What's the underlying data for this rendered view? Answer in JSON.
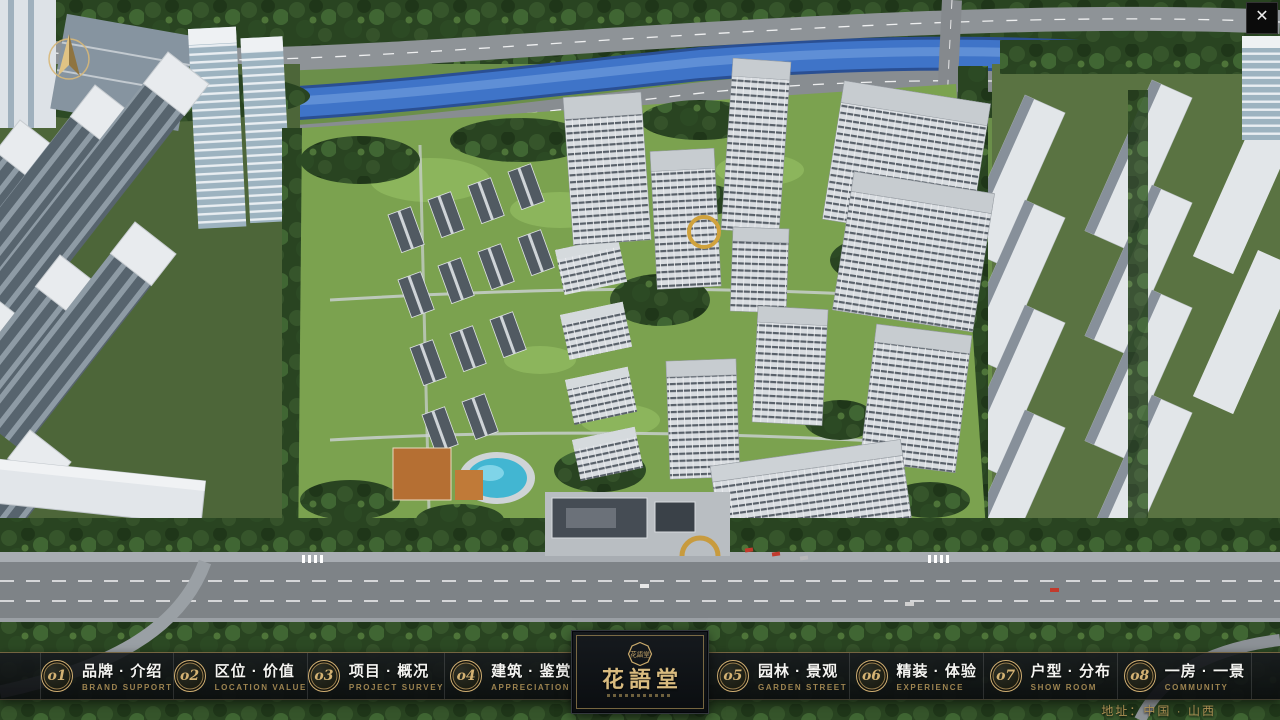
{
  "theme": {
    "accent_gold": "#c9a96b",
    "nav_background": "rgba(16,18,20,0.92)",
    "label_white": "#f4f4f1",
    "subtitle_gold": "#9d8450",
    "address_gold": "#ad9154",
    "river_blue": "#3f74c8",
    "foliage_green": "#2c4a24"
  },
  "icons": {
    "close": "✕",
    "compass": "north-arrow",
    "seal": "花語堂"
  },
  "nav": {
    "items": [
      {
        "num": "o1",
        "label": "品牌 · 介绍",
        "sub": "BRAND SUPPORT"
      },
      {
        "num": "o2",
        "label": "区位 · 价值",
        "sub": "LOCATION VALUE"
      },
      {
        "num": "o3",
        "label": "项目 · 概况",
        "sub": "PROJECT SURVEY"
      },
      {
        "num": "o4",
        "label": "建筑 · 鉴赏",
        "sub": "APPRECIATION"
      },
      {
        "num": "o5",
        "label": "园林 · 景观",
        "sub": "GARDEN STREET"
      },
      {
        "num": "o6",
        "label": "精装 · 体验",
        "sub": "EXPERIENCE"
      },
      {
        "num": "o7",
        "label": "户型 · 分布",
        "sub": "SHOW ROOM"
      },
      {
        "num": "o8",
        "label": "一房 · 一景",
        "sub": "COMMUNITY"
      }
    ]
  },
  "logo": {
    "title": "花語堂",
    "seal_text": "花語堂"
  },
  "footer": {
    "address": "地址：中国 · 山西"
  }
}
